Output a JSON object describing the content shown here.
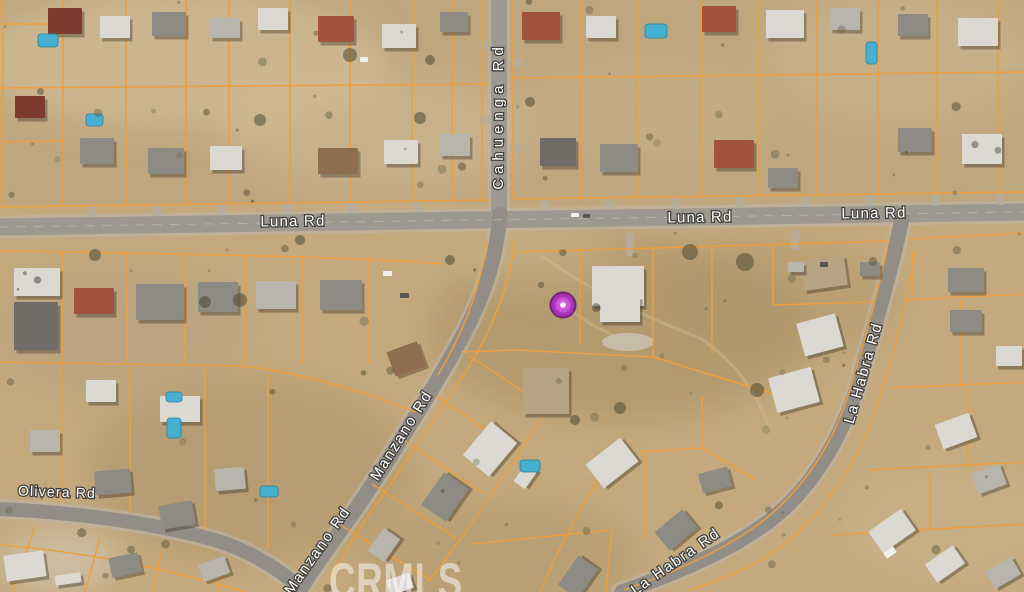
{
  "map": {
    "type": "satellite-parcel-map",
    "marker": {
      "x": 563,
      "y": 305,
      "fill": "#c93fd4",
      "ring": "#a32cb4",
      "edge": "#6d1678",
      "center_dot": "#ffffff"
    },
    "watermark": {
      "text": "CRMLS"
    },
    "road_labels": [
      {
        "id": "cahuenga-rd",
        "text": "Cahuenga Rd"
      },
      {
        "id": "luna-rd-west",
        "text": "Luna Rd"
      },
      {
        "id": "luna-rd-center",
        "text": "Luna Rd"
      },
      {
        "id": "luna-rd-east",
        "text": "Luna Rd"
      },
      {
        "id": "olivera-rd",
        "text": "Olivera Rd"
      },
      {
        "id": "manzano-rd-upper",
        "text": "Manzano Rd"
      },
      {
        "id": "manzano-rd-lower",
        "text": "Manzano Rd"
      },
      {
        "id": "la-habra-rd-upper",
        "text": "La Habra Rd"
      },
      {
        "id": "la-habra-rd-lower",
        "text": "La Habra Rd"
      }
    ],
    "colors": {
      "ground": "#c3a97d",
      "road": "#9d9890",
      "parcel_line": "#f09d3b",
      "label_text": "#ffffff",
      "label_halo": "#41403c",
      "watermark": "#ffffff"
    }
  }
}
